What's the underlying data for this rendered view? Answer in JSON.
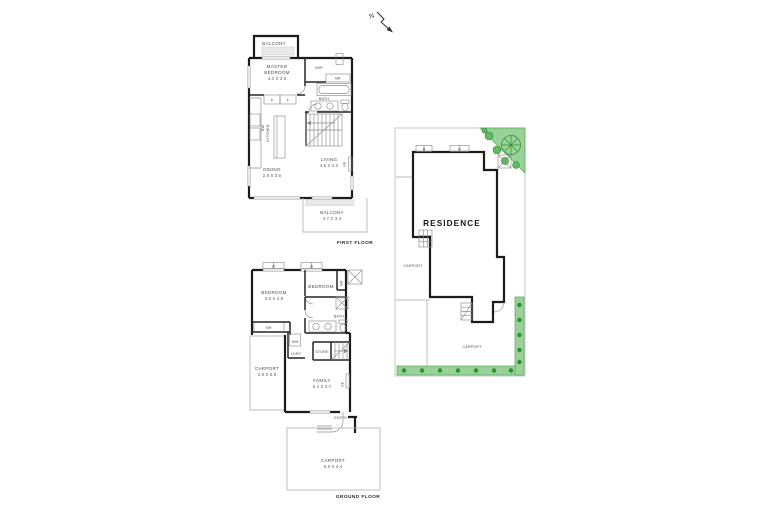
{
  "north": {
    "label": "N"
  },
  "first_floor": {
    "title": "FIRST FLOOR",
    "balcony_top": {
      "name": "BALCONY"
    },
    "master_bedroom": {
      "line1": "MASTER",
      "line2": "BEDROOM",
      "dims": "4.0 X 3.5"
    },
    "wir": {
      "name": "WIR"
    },
    "robe": {
      "name": "BR"
    },
    "bath": {
      "name": "BATH"
    },
    "pantry": {
      "name": "P"
    },
    "fridge": {
      "name": "F"
    },
    "kitchen": {
      "name": "KITCHEN"
    },
    "dishwasher": {
      "name": "DW"
    },
    "living": {
      "name": "LIVING",
      "dims": "4.5 X 4.3"
    },
    "fireplace": {
      "name": "FP"
    },
    "dining": {
      "name": "DINING",
      "dims": "2.8 X 3.5"
    },
    "balcony_bottom": {
      "name": "BALCONY",
      "dims": "4.7 X 3.4"
    }
  },
  "ground_floor": {
    "title": "GROUND FLOOR",
    "bedroom_left": {
      "name": "BEDROOM",
      "dims": "3.8 X 4.8"
    },
    "bedroom_right": {
      "name": "BEDROOM"
    },
    "robe_right": {
      "name": "BR"
    },
    "robe_left": {
      "name": "BR"
    },
    "bath": {
      "name": "BATH"
    },
    "washing_machine": {
      "name": "WM"
    },
    "laundry": {
      "name": "LDRY"
    },
    "store": {
      "name": "STORE"
    },
    "carport_left": {
      "name": "CARPORT",
      "dims": "2.8 X 5.8"
    },
    "family": {
      "name": "FAMILY",
      "dims": "5.4 X 3.7"
    },
    "fireplace": {
      "name": "FP"
    },
    "entry": {
      "name": "ENTRY"
    },
    "carport_bottom": {
      "name": "CARPORT",
      "dims": "6.8 X 4.4"
    }
  },
  "site_plan": {
    "residence_label": "RESIDENCE",
    "carport_left_label": "CARPORT",
    "carport_bottom_label": "CARPORT"
  },
  "colors": {
    "wall": "#1c1c1c",
    "fixture_line": "#8c8c8c",
    "light_line": "#b9b9b9",
    "landscape_fill": "#99d199",
    "landscape_dark": "#2f8f2f",
    "label_text": "#4f4f4f"
  }
}
